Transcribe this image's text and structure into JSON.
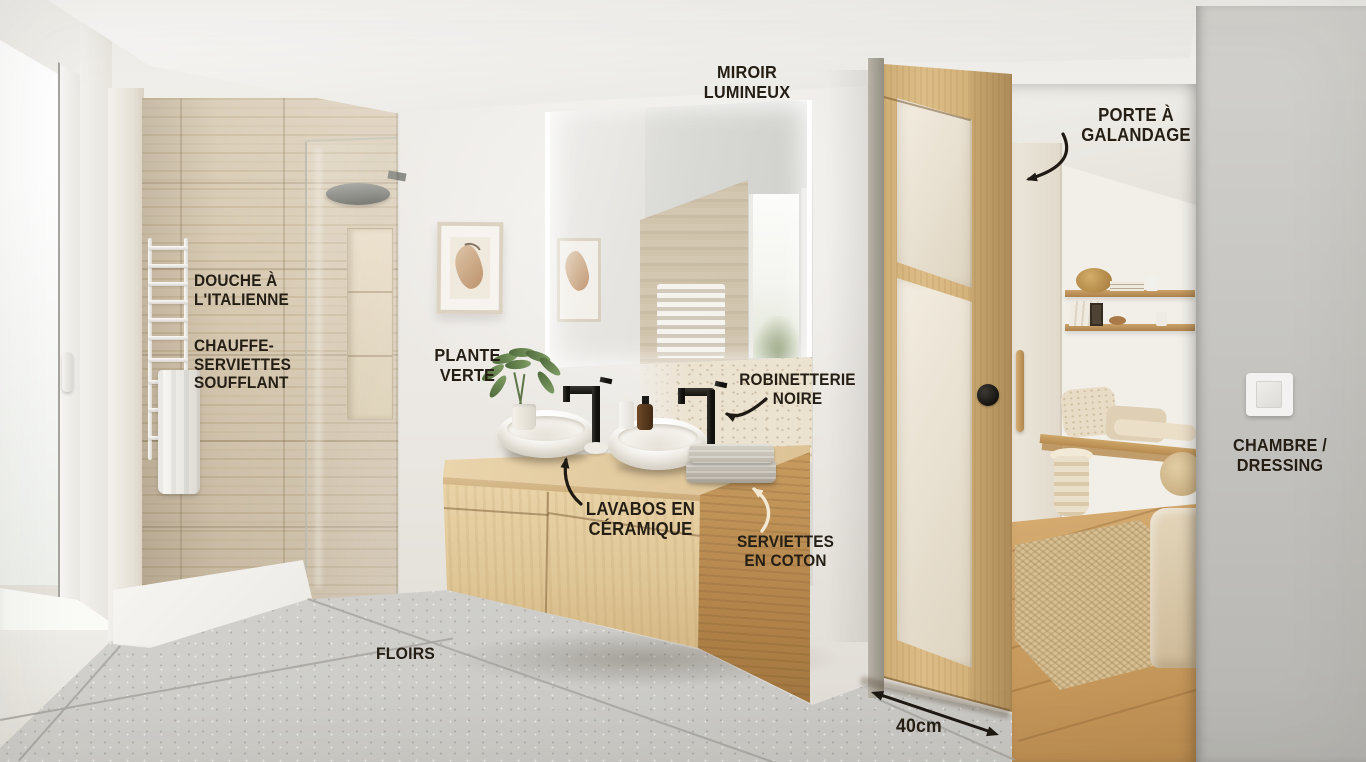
{
  "annotations": {
    "miroir_lumineux": {
      "lines": [
        "MIROIR",
        "LUMINEUX"
      ]
    },
    "porte_a_galandage": {
      "lines": [
        "PORTE À GALANDAGE"
      ]
    },
    "douche_italienne": {
      "lines": [
        "DOUCHE À L'ITALIENNE"
      ]
    },
    "chauffe_serviettes": {
      "lines": [
        "CHAUFFE-SERVIETTES",
        "SOUFFLANT"
      ]
    },
    "plante_verte": {
      "lines": [
        "PLANTE",
        "VERTE"
      ]
    },
    "robinetterie_noire": {
      "lines": [
        "ROBINETTERIE",
        "NOIRE"
      ]
    },
    "lavabos_ceramique": {
      "lines": [
        "LAVABOS EN",
        "CÉRAMIQUE"
      ]
    },
    "serviettes_coton": {
      "lines": [
        "SERVIETTES",
        "EN COTON"
      ]
    },
    "chambre_dressing": {
      "lines": [
        "CHAMBRE /",
        "DRESSING"
      ]
    },
    "floirs": {
      "lines": [
        "FLOIRS"
      ]
    },
    "dimension": {
      "value": "40cm"
    }
  },
  "colors": {
    "annotation_text": "#241e15",
    "arrow_dark": "#1e1913",
    "arrow_cream": "#f3e9d4",
    "oak_wood": "#d8b77f",
    "travertine": "#d5c7af",
    "wall_white": "#efece8",
    "near_wall_gray": "#c6c5c1",
    "floor_terrazzo": "#d4d3cf",
    "faucet_black": "#1d1b18",
    "frosted_glass": "#eae2d2"
  }
}
